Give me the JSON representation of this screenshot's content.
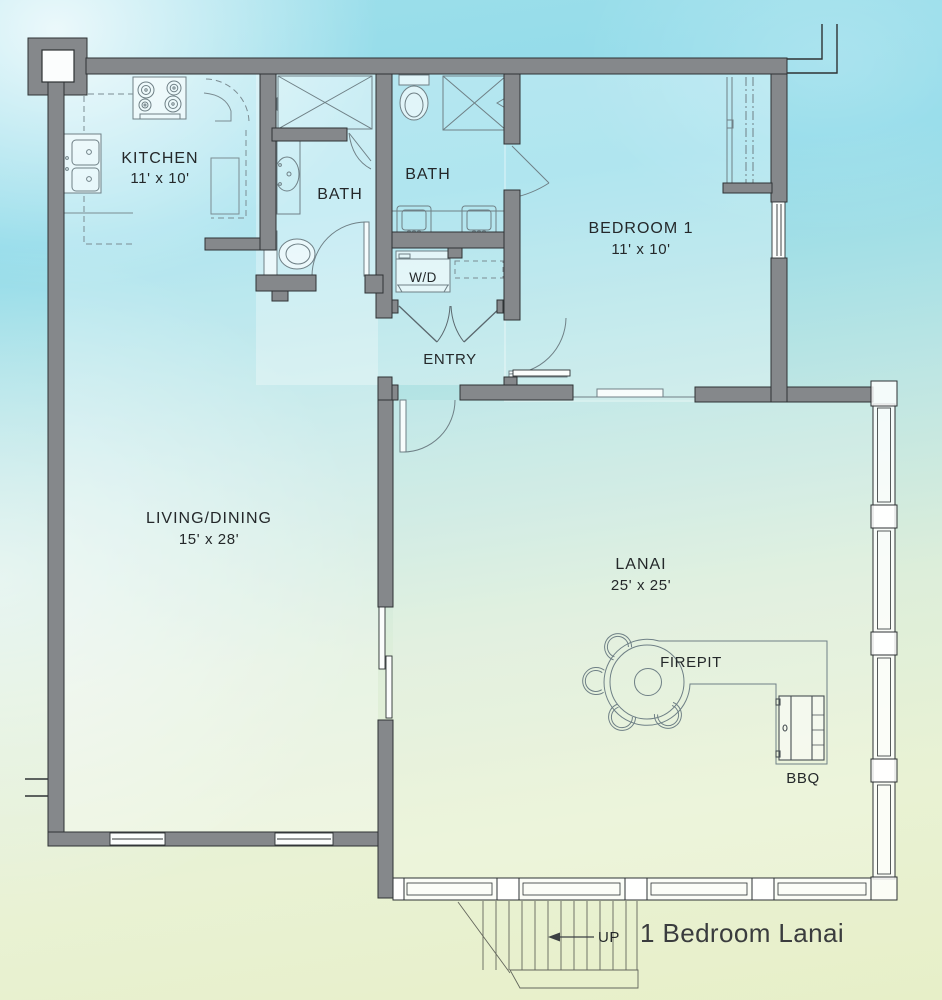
{
  "title": "1 Bedroom Lanai",
  "rooms": {
    "kitchen": {
      "name": "KITCHEN",
      "dims": "11' x 10'"
    },
    "bath1": {
      "name": "BATH"
    },
    "bath2": {
      "name": "BATH"
    },
    "bedroom1": {
      "name": "BEDROOM 1",
      "dims": "11' x 10'"
    },
    "laundry": {
      "name": "W/D"
    },
    "entry": {
      "name": "ENTRY"
    },
    "living_dining": {
      "name": "LIVING/DINING",
      "dims": "15' x 28'"
    },
    "lanai": {
      "name": "LANAI",
      "dims": "25' x 25'"
    }
  },
  "features": {
    "firepit": "FIREPIT",
    "bbq": "BBQ",
    "stairs_direction": "UP"
  },
  "colors": {
    "wall_fill": "#85888b",
    "wall_outline": "#2e3234",
    "fixture_line": "#6f8086",
    "text": "#24282a",
    "bg_top": "#8edae9",
    "bg_bottom": "#e7efc8"
  }
}
